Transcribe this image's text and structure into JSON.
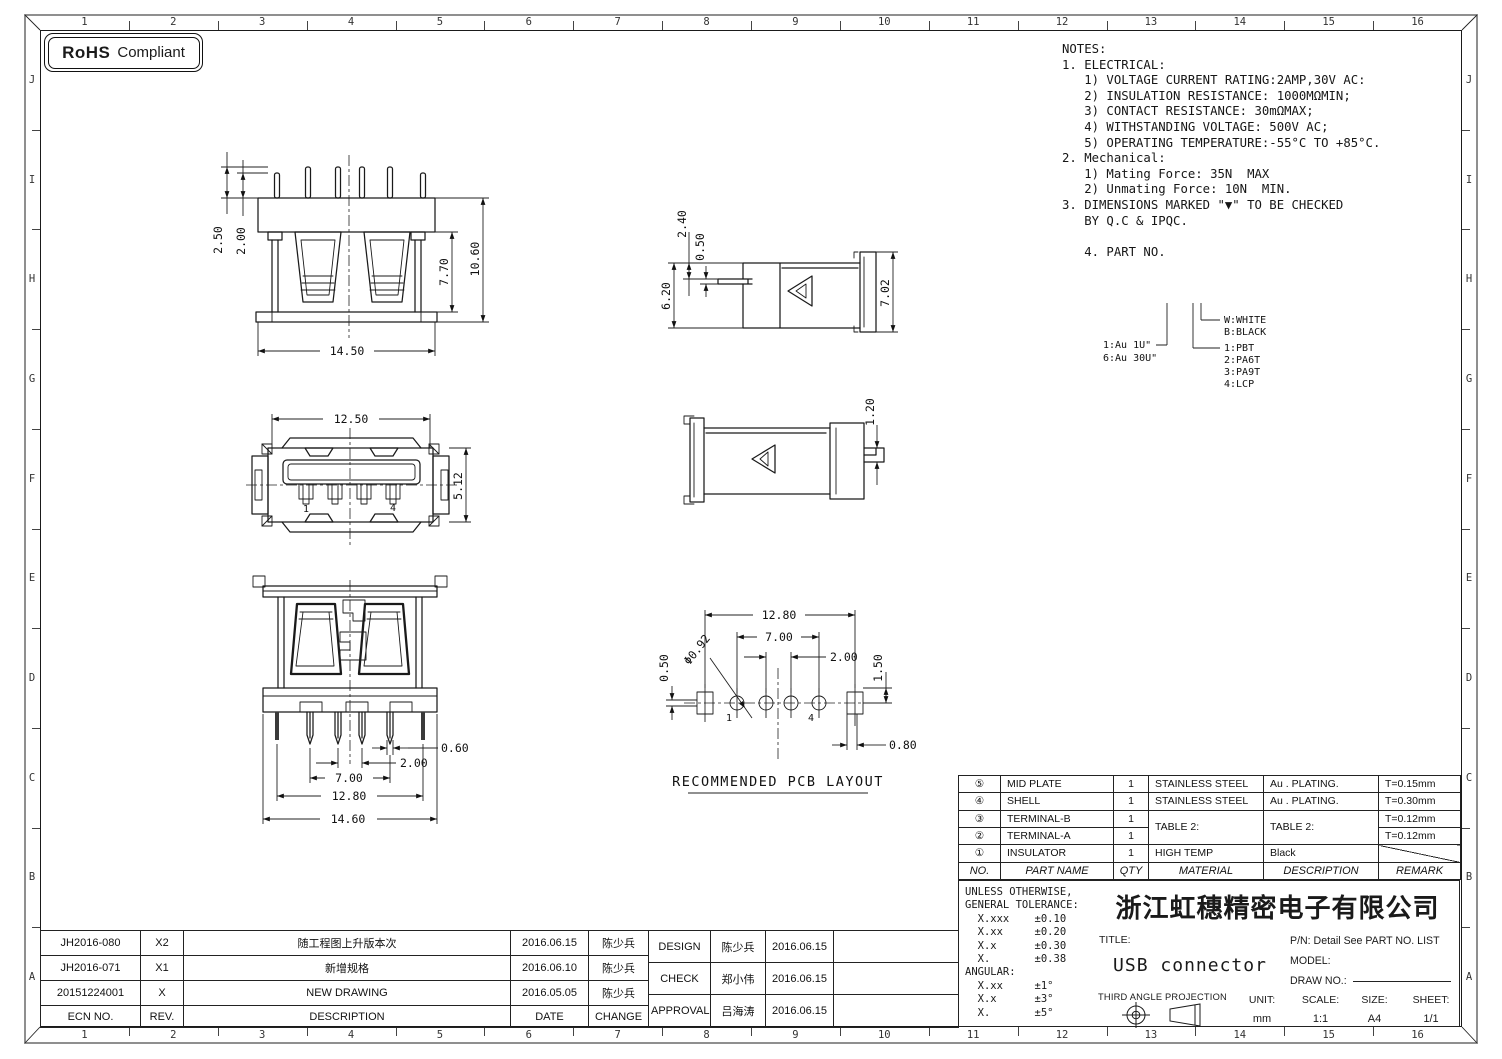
{
  "colors": {
    "line": "#1a1a1a",
    "frame_gray": "#8f8f8f",
    "accent_red": "#9e352c",
    "paper": "#ffffff"
  },
  "border": {
    "columns": [
      "1",
      "2",
      "3",
      "4",
      "5",
      "6",
      "7",
      "8",
      "9",
      "10",
      "11",
      "12",
      "13",
      "14",
      "15",
      "16"
    ],
    "rows": [
      "J",
      "I",
      "H",
      "G",
      "F",
      "E",
      "D",
      "C",
      "B",
      "A"
    ]
  },
  "rohs": {
    "bold": "RoHS",
    "rest": "Compliant"
  },
  "notes": {
    "lines": [
      "NOTES:",
      "1. ELECTRICAL:",
      "   1) VOLTAGE CURRENT RATING:2AMP,30V AC:",
      "   2) INSULATION RESISTANCE: 1000MΩMIN;",
      "   3) CONTACT RESISTANCE: 30mΩMAX;",
      "   4) WITHSTANDING VOLTAGE: 500V AC;",
      "   5) OPERATING TEMPERATURE:-55°C TO +85°C.",
      "2. Mechanical:",
      "   1) Mating Force: 35N  MAX",
      "   2) Unmating Force: 10N  MIN.",
      "3. DIMENSIONS MARKED \"▼\" TO BE CHECKED",
      "   BY Q.C & IPQC.",
      "",
      "   4. PART NO."
    ]
  },
  "legend": {
    "left1": "1:Au 1U\"",
    "left2": "6:Au 30U\"",
    "r1": "W:WHITE",
    "r2": "B:BLACK",
    "r3": "1:PBT",
    "r4": "2:PA6T",
    "r5": "3:PA9T",
    "r6": "4:LCP"
  },
  "views": {
    "rear": {
      "d_250": "2.50",
      "d_200": "2.00",
      "d_770": "7.70",
      "d_1060": "10.60",
      "d_1450": "14.50"
    },
    "front": {
      "d_1250": "12.50",
      "d_512": "5.12",
      "pin1": "1",
      "pin4": "4"
    },
    "bottom": {
      "d_060": "0.60",
      "d_200": "2.00",
      "d_700": "7.00",
      "d_1280": "12.80",
      "d_1460": "14.60"
    },
    "side_a": {
      "d_240": "2.40",
      "d_050": "0.50",
      "d_620": "6.20",
      "d_702": "7.02"
    },
    "side_b": {
      "d_120": "1.20"
    },
    "pcb": {
      "d_1280": "12.80",
      "d_700": "7.00",
      "d_200": "2.00",
      "d_050": "0.50",
      "d_092": "Φ0.92",
      "d_150": "1.50",
      "d_080": "0.80",
      "pin1": "1",
      "pin4": "4",
      "caption": "RECOMMENDED PCB LAYOUT"
    }
  },
  "parts_table": {
    "header": [
      "NO.",
      "PART NAME",
      "QTY",
      "MATERIAL",
      "DESCRIPTION",
      "REMARK"
    ],
    "rows": [
      [
        "⑤",
        "MID PLATE",
        "1",
        "STAINLESS STEEL",
        "Au . PLATING.",
        "T=0.15mm"
      ],
      [
        "④",
        "SHELL",
        "1",
        "STAINLESS STEEL",
        "Au . PLATING.",
        "T=0.30mm"
      ],
      [
        "③",
        "TERMINAL-B",
        "1",
        "TABLE 2:",
        "TABLE 2:",
        "T=0.12mm"
      ],
      [
        "②",
        "TERMINAL-A",
        "1",
        "",
        "",
        "T=0.12mm"
      ],
      [
        "①",
        "INSULATOR",
        "1",
        "HIGH TEMP",
        "Black",
        ""
      ]
    ]
  },
  "tolerance": {
    "lines": [
      "UNLESS OTHERWISE,",
      "GENERAL TOLERANCE:",
      "  X.xxx    ±0.10",
      "  X.xx     ±0.20",
      "  X.x      ±0.30",
      "  X.       ±0.38",
      "ANGULAR:",
      "  X.xx     ±1°",
      "  X.x      ±3°",
      "  X.       ±5°"
    ]
  },
  "title_block": {
    "company": "浙江虹穗精密电子有限公司",
    "title_label": "TITLE:",
    "title": "USB connector",
    "pn": "P/N: Detail See PART NO. LIST",
    "model_label": "MODEL:",
    "draw_no_label": "DRAW NO.:",
    "projection_label": "THIRD ANGLE PROJECTION",
    "unit_label": "UNIT:",
    "unit": "mm",
    "scale_label": "SCALE:",
    "scale": "1:1",
    "size_label": "SIZE:",
    "size": "A4",
    "sheet_label": "SHEET:",
    "sheet": "1/1"
  },
  "revision_table": {
    "header": [
      "ECN NO.",
      "REV.",
      "DESCRIPTION",
      "DATE",
      "CHANGE"
    ],
    "rows": [
      [
        "JH2016-080",
        "X2",
        "随工程图上升版本次",
        "2016.06.15",
        "陈少兵"
      ],
      [
        "JH2016-071",
        "X1",
        "新增规格",
        "2016.06.10",
        "陈少兵"
      ],
      [
        "20151224001",
        "X",
        "NEW DRAWING",
        "2016.05.05",
        "陈少兵"
      ]
    ],
    "signoff": [
      [
        "DESIGN",
        "陈少兵",
        "2016.06.15"
      ],
      [
        "CHECK",
        "郑小伟",
        "2016.06.15"
      ],
      [
        "APPROVAL",
        "吕海涛",
        "2016.06.15"
      ]
    ]
  }
}
